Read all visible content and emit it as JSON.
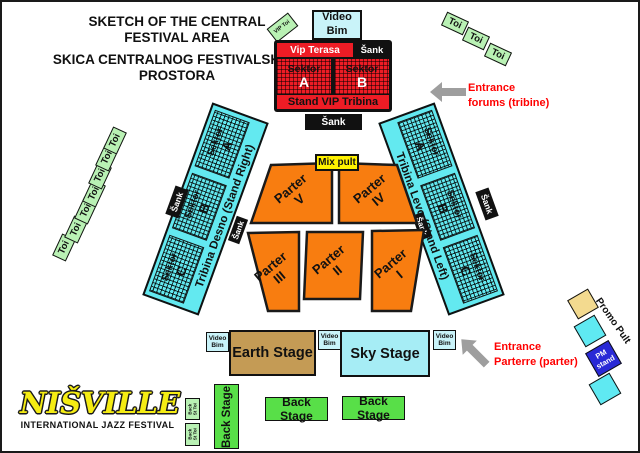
{
  "titles": {
    "line1": "SKETCH OF THE CENTRAL FESTIVAL AREA",
    "line2": "SKICA CENTRALNOG FESTIVALSKOG PROSTORA"
  },
  "labels": {
    "toi": "Toi",
    "vip_toi": "VIP Toi",
    "video_bim": "Video Bim",
    "sank": "Šank",
    "mix_pult": "Mix pult",
    "back_st_toi": "Back St Toi",
    "sektor": "Sektor"
  },
  "vip": {
    "terasa": "Vip Terasa",
    "sectors": [
      "A",
      "B"
    ],
    "stand": "Stand VIP Tribina"
  },
  "tribunes": {
    "right_name": "Tribina Desno (Stand Right)",
    "left_name": "Tribina Levo (Stand Left)",
    "sectors": [
      "A",
      "B",
      "C"
    ]
  },
  "parterre": {
    "word": "Parter",
    "sections": [
      "V",
      "IV",
      "III",
      "II",
      "I"
    ]
  },
  "stages": {
    "earth": "Earth Stage",
    "sky": "Sky Stage",
    "back": "Back Stage"
  },
  "entrances": {
    "forums_line1": "Entrance",
    "forums_line2": "forums (tribine)",
    "parterre_line1": "Entrance",
    "parterre_line2": "Parterre (parter)"
  },
  "promo": {
    "label": "Promo Pult",
    "pm_stand": "PM stand"
  },
  "logo": {
    "name": "NIŠVILLE",
    "subtitle": "INTERNATIONAL JAZZ FESTIVAL"
  },
  "colors": {
    "orange": "#f87d10",
    "tribune_cyan": "#63e9f0",
    "video_bim_cyan": "#c9f3f9",
    "sky_cyan": "#a6edf5",
    "earth_tan": "#c49b55",
    "red": "#ee1c25",
    "toi_green": "#b9f1b4",
    "backstage_green": "#58df48",
    "mix_yellow": "#fff200",
    "promo_yellow": "#f3da8f",
    "pm_blue": "#2929d6",
    "entrance_text_red": "#ff0000",
    "arrow_gray": "#9e9e9e",
    "logo_yellow": "#f5ec13"
  }
}
